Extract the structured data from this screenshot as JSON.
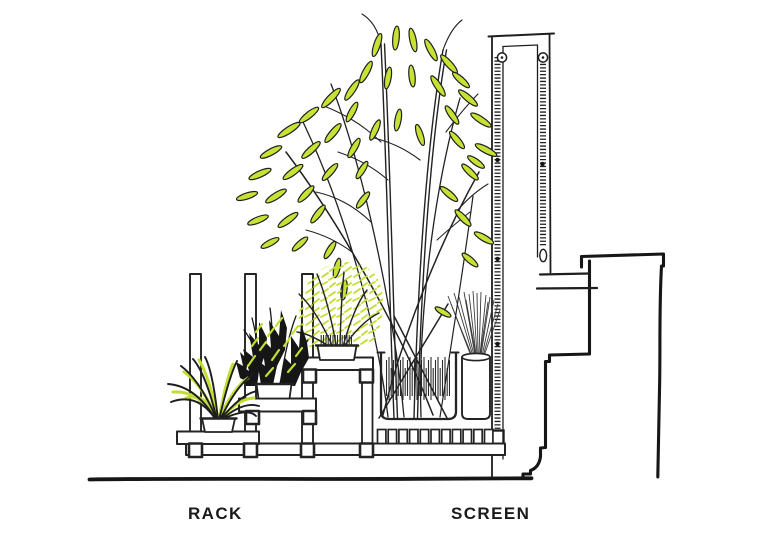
{
  "labels": {
    "rack": "RACK",
    "screen": "SCREEN"
  },
  "palette": {
    "ink": "#1e1e1e",
    "leaf_green": "#c8e135",
    "paper": "#ffffff"
  }
}
